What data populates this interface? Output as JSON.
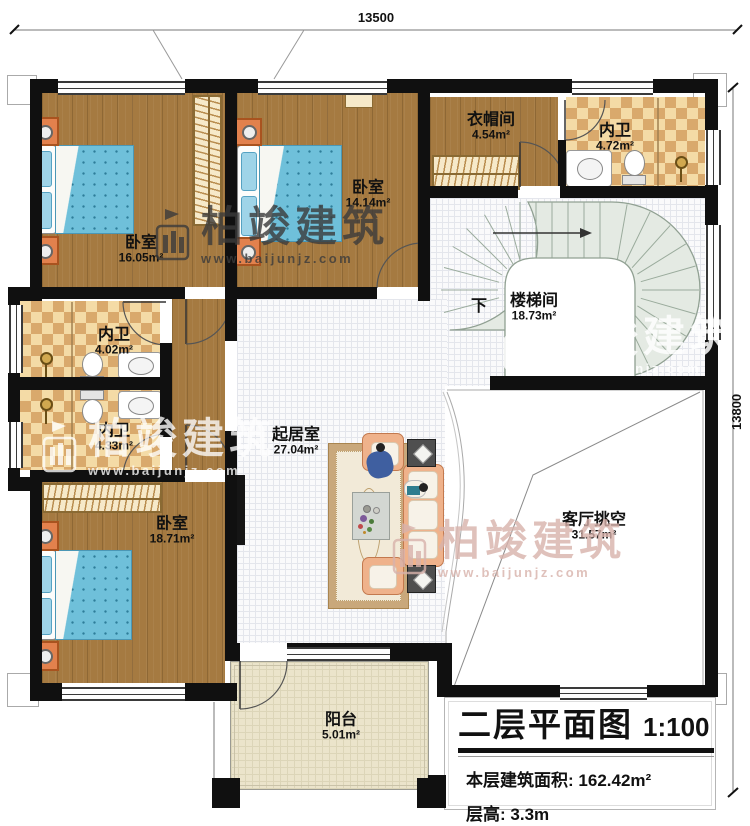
{
  "dimensions": {
    "width_top": "13500",
    "height_right": "13800"
  },
  "rooms": [
    {
      "name": "卧室",
      "area": "16.05m²"
    },
    {
      "name": "卧室",
      "area": "14.14m²"
    },
    {
      "name": "衣帽间",
      "area": "4.54m²"
    },
    {
      "name": "内卫",
      "area": "4.72m²"
    },
    {
      "name": "楼梯间",
      "area": "18.73m²"
    },
    {
      "name": "内卫",
      "area": "4.02m²"
    },
    {
      "name": "内卫",
      "area": "4.33m²"
    },
    {
      "name": "起居室",
      "area": "27.04m²"
    },
    {
      "name": "卧室",
      "area": "18.71m²"
    },
    {
      "name": "客厅挑空",
      "area": "31.57m²"
    },
    {
      "name": "阳台",
      "area": "5.01m²"
    }
  ],
  "stair": {
    "down_label": "下"
  },
  "title_block": {
    "title": "二层平面图",
    "scale": "1:100",
    "area_label": "本层建筑面积:",
    "area_value": "162.42m²",
    "floor_height_label": "层高:",
    "floor_height_value": "3.3m"
  },
  "watermark": {
    "brand": "柏竣建筑",
    "url": "www.baijunjz.com"
  },
  "colors": {
    "wall": "#101010",
    "wood": "#a57a41",
    "tile_dark": "#d9a96c",
    "stair": "#e4eae3",
    "balcony": "#ebe4cb",
    "bed": "#6fc0da",
    "sofa": "#efb28b",
    "watermark_pink": "#d8b2ab"
  }
}
